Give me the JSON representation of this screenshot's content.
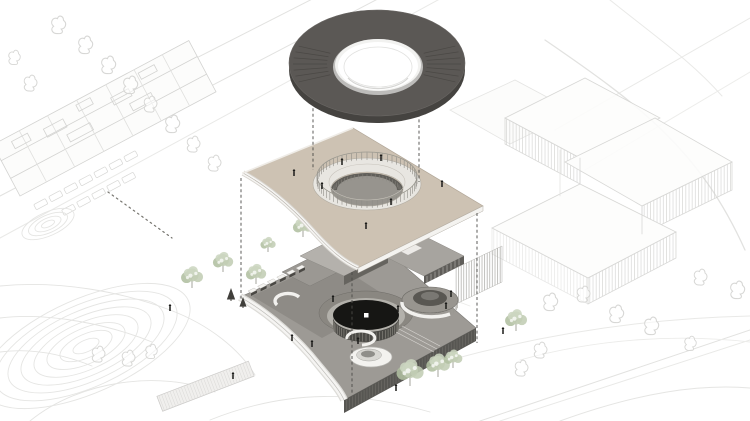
{
  "figure": {
    "type": "architectural-exploded-axonometric-diagram",
    "visible_text": "",
    "exploded_layers": [
      {
        "name": "roof-canopy-torus",
        "order": "top",
        "shape": "dark torus ring with circular oculus"
      },
      {
        "name": "upper-floor-plate",
        "order": "middle",
        "shape": "beige square plate, concave lower-left cut, circular ring colonnade around courtyard opening"
      },
      {
        "name": "ground-level-plinth",
        "order": "bottom",
        "shape": "grey plinth with dark central rotunda disc, spiral drum, funnel skylight, gate row"
      }
    ]
  },
  "colors": {
    "background": "#ffffff",
    "context_line": "#d7d7d5",
    "context_line_faint": "#e5e5e3",
    "torus_top": "#5b5855",
    "torus_rim": "#454340",
    "torus_streak": "#3e3c39",
    "torus_inner_rim": "#bdbcba",
    "torus_inner_ring": "#f2f2f0",
    "torus_hole": "#ffffff",
    "plate_top": "#cdc2b3",
    "plate_line": "#b1a697",
    "plate_edge_white": "#f4f3f0",
    "ring_walkway": "#e8e6e1",
    "ring_post": "#8f8d87",
    "courtyard_hole": "#97948e",
    "courtyard_wall": "#615f5a",
    "plinth_top": "#9d9a95",
    "plinth_plaza": "#8e8b86",
    "plinth_wall": "#575652",
    "rotunda_terrace": "#8a8781",
    "rotunda_walkway": "#b3b1ab",
    "rotunda_disc": "#161614",
    "rotunda_skylight": "#ffffff",
    "drum_wall": "#4a4945",
    "drum_slat": "#8d8b83",
    "box_roof_light": "#b4b1ac",
    "box_roof_mid": "#a7a49f",
    "box_wall": "#66645f",
    "white_wall": "#f3f2ef",
    "tree_green_1": "#c2cdb4",
    "tree_green_2": "#b0bfa0",
    "tree_green_3": "#ccd6c0",
    "tree_trunk": "#8f8e85",
    "pine_dark": "#403f3b",
    "person": "#1b1b19",
    "dashed_guide": "#4b4a47"
  },
  "geometry": {
    "torus": {
      "cx": 377,
      "cy": 64,
      "rx": 88,
      "ry": 54
    },
    "ring": {
      "cx": 367,
      "cy": 184,
      "rx": 50,
      "ry": 24
    },
    "courtyard": {
      "cx": 367,
      "cy": 190,
      "rx": 36,
      "ry": 17
    },
    "rotunda": {
      "cx": 366,
      "cy": 317,
      "rx": 33,
      "ry": 15
    },
    "right_drum": {
      "cx": 430,
      "cy": 300,
      "rx": 28,
      "ry": 13
    },
    "front_wall": {
      "x1": 344,
      "y1": 400,
      "x2": 476,
      "y2": 328,
      "h": 13
    },
    "gates": {
      "x": 251,
      "y": 294,
      "dx": 9.6,
      "dy": -4.6,
      "count": 6
    }
  },
  "dashed_guides": [
    {
      "x": 313,
      "y1": 97,
      "y2": 170
    },
    {
      "x": 419,
      "y1": 97,
      "y2": 182
    },
    {
      "x": 241,
      "y1": 178,
      "y2": 300
    },
    {
      "x": 477,
      "y1": 213,
      "y2": 343
    },
    {
      "x": 352,
      "y1": 272,
      "y2": 393
    }
  ],
  "people": {
    "plate": [
      [
        294,
        176
      ],
      [
        442,
        187
      ],
      [
        366,
        229
      ],
      [
        342,
        165
      ],
      [
        381,
        161
      ],
      [
        322,
        189
      ],
      [
        391,
        205
      ]
    ],
    "ground": [
      [
        312,
        347
      ],
      [
        358,
        344
      ],
      [
        333,
        302
      ],
      [
        398,
        312
      ],
      [
        446,
        309
      ],
      [
        170,
        311
      ],
      [
        233,
        379
      ],
      [
        396,
        391
      ],
      [
        503,
        334
      ],
      [
        451,
        297
      ],
      [
        292,
        341
      ]
    ]
  },
  "trees": {
    "green": [
      [
        192,
        288,
        13
      ],
      [
        223,
        272,
        12
      ],
      [
        256,
        284,
        12
      ],
      [
        303,
        237,
        12
      ],
      [
        268,
        252,
        9
      ],
      [
        410,
        386,
        16
      ],
      [
        438,
        377,
        14
      ],
      [
        453,
        368,
        11
      ],
      [
        516,
        331,
        13
      ]
    ],
    "pine": [
      [
        231,
        301,
        13
      ],
      [
        243,
        308,
        11
      ]
    ]
  },
  "context": {
    "outline_trees": [
      [
        58,
        28,
        11
      ],
      [
        85,
        48,
        11
      ],
      [
        108,
        68,
        11
      ],
      [
        130,
        88,
        11
      ],
      [
        150,
        107,
        10
      ],
      [
        172,
        127,
        11
      ],
      [
        193,
        147,
        10
      ],
      [
        214,
        166,
        10
      ],
      [
        30,
        86,
        10
      ],
      [
        14,
        60,
        9
      ],
      [
        98,
        357,
        10
      ],
      [
        128,
        361,
        10
      ],
      [
        151,
        354,
        9
      ],
      [
        550,
        305,
        11
      ],
      [
        583,
        297,
        10
      ],
      [
        616,
        317,
        11
      ],
      [
        651,
        329,
        11
      ],
      [
        540,
        353,
        10
      ],
      [
        521,
        371,
        10
      ],
      [
        737,
        293,
        11
      ],
      [
        700,
        280,
        10
      ],
      [
        690,
        346,
        9
      ]
    ],
    "cars": {
      "row1": 7,
      "row2": 5
    },
    "paving_arcs": {
      "cx": 86,
      "cy": 346,
      "radii": [
        14,
        28,
        42,
        56,
        70,
        84,
        98,
        112
      ]
    },
    "paving_arcs_small": {
      "cx": 48,
      "cy": 224,
      "radii": [
        7,
        14,
        21,
        28
      ]
    }
  }
}
